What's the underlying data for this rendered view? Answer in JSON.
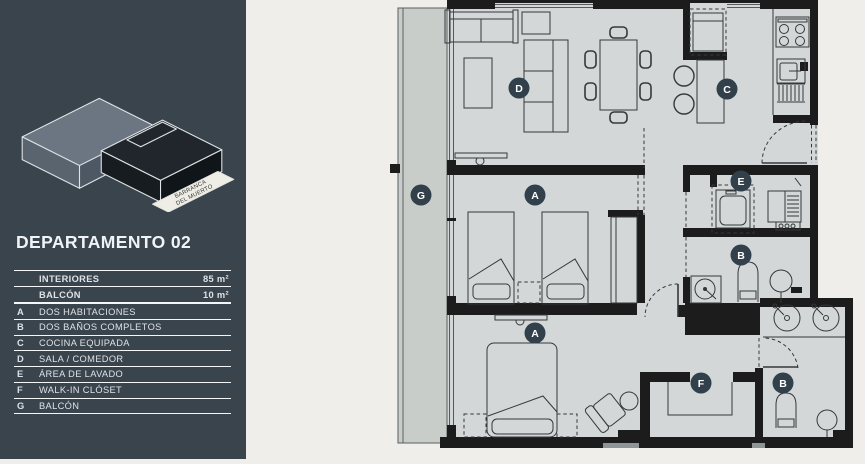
{
  "sidebar": {
    "title": "DEPARTAMENTO 02",
    "logo": {
      "ribbon_line1": "BARRANCA",
      "ribbon_line2": "DEL MUERTO"
    },
    "areas": [
      {
        "label": "INTERIORES",
        "value": "85 m²"
      },
      {
        "label": "BALCÓN",
        "value": "10 m²"
      }
    ],
    "legend": [
      {
        "key": "A",
        "label": "DOS HABITACIONES"
      },
      {
        "key": "B",
        "label": "DOS BAÑOS COMPLETOS"
      },
      {
        "key": "C",
        "label": "COCINA EQUIPADA"
      },
      {
        "key": "D",
        "label": "SALA / COMEDOR"
      },
      {
        "key": "E",
        "label": "ÁREA DE LAVADO"
      },
      {
        "key": "F",
        "label": "WALK-IN CLÓSET"
      },
      {
        "key": "G",
        "label": "BALCÓN"
      }
    ]
  },
  "plan": {
    "room_markers": [
      {
        "key": "D",
        "x": 519,
        "y": 88
      },
      {
        "key": "C",
        "x": 727,
        "y": 89
      },
      {
        "key": "G",
        "x": 421,
        "y": 195
      },
      {
        "key": "A",
        "x": 535,
        "y": 195
      },
      {
        "key": "E",
        "x": 741,
        "y": 181
      },
      {
        "key": "B",
        "x": 741,
        "y": 255
      },
      {
        "key": "A",
        "x": 535,
        "y": 333
      },
      {
        "key": "F",
        "x": 701,
        "y": 383
      },
      {
        "key": "B",
        "x": 783,
        "y": 383
      }
    ]
  },
  "colors": {
    "sidebar_bg": "#3a444d",
    "page_bg": "#efeeea",
    "floor": "#d3d7d8",
    "balcony_floor": "#c9cdca",
    "wall": "#1c1c1c",
    "marker_bg": "#31404b",
    "marker_text": "#ffffff",
    "logo_gray": "#6b7682",
    "logo_dark": "#20262c"
  }
}
